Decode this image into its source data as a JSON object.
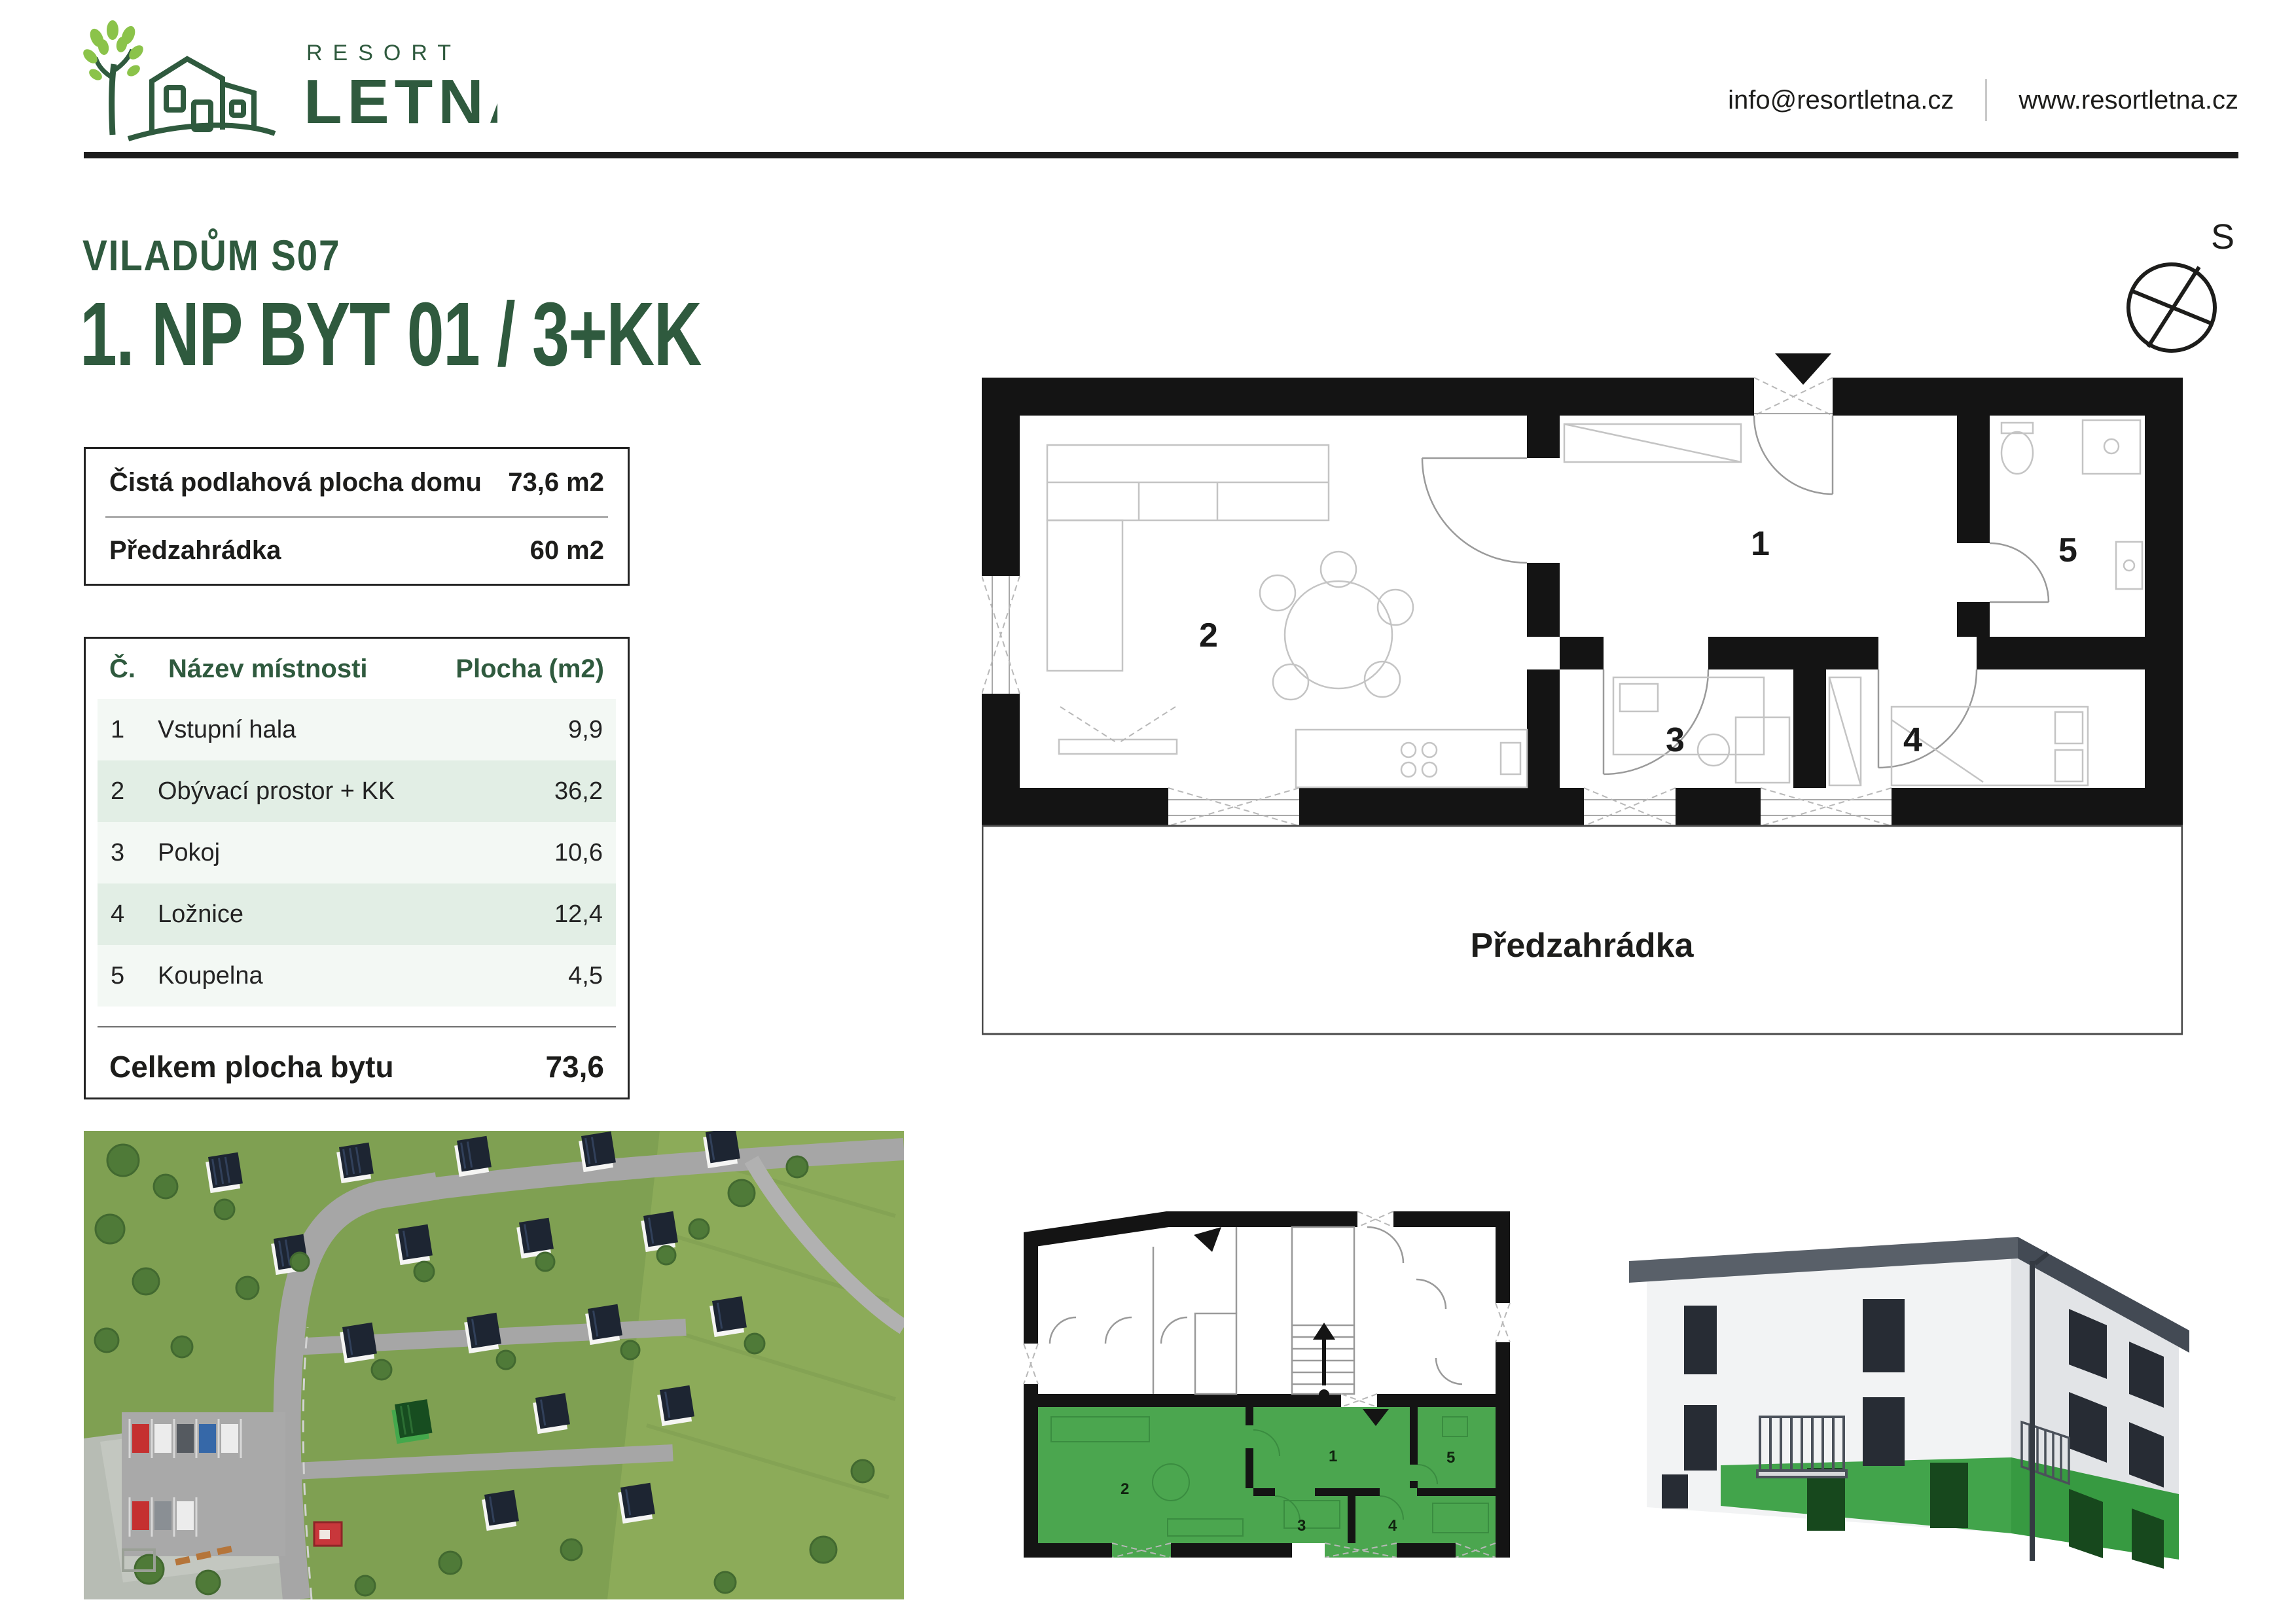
{
  "header": {
    "brand_top": "RESORT",
    "brand_bottom": "LETNÁ",
    "email": "info@resortletna.cz",
    "website": "www.resortletna.cz"
  },
  "title": {
    "project": "VILADŮM S07",
    "unit": "1. NP BYT 01 / 3+KK"
  },
  "summary": {
    "rows": [
      {
        "label": "Čistá podlahová plocha domu",
        "value": "73,6 m2"
      },
      {
        "label": "Předzahrádka",
        "value": "60 m2"
      }
    ]
  },
  "room_table": {
    "headers": {
      "number": "Č.",
      "name": "Název místnosti",
      "area": "Plocha (m2)"
    },
    "rows": [
      {
        "number": "1",
        "name": "Vstupní hala",
        "area": "9,9"
      },
      {
        "number": "2",
        "name": "Obývací prostor + KK",
        "area": "36,2"
      },
      {
        "number": "3",
        "name": "Pokoj",
        "area": "10,6"
      },
      {
        "number": "4",
        "name": "Ložnice",
        "area": "12,4"
      },
      {
        "number": "5",
        "name": "Koupelna",
        "area": "4,5"
      }
    ],
    "total": {
      "label": "Celkem plocha bytu",
      "value": "73,6"
    }
  },
  "floor_plan": {
    "room_labels": [
      "1",
      "2",
      "3",
      "4",
      "5"
    ],
    "garden_label": "Předzahrádka"
  },
  "compass": {
    "label": "S"
  },
  "mini_plan": {
    "room_labels": [
      "1",
      "2",
      "3",
      "4",
      "5"
    ]
  },
  "colors": {
    "accent_green": "#2f5a3e",
    "leaf_green": "#8bc34a",
    "highlight_green": "#4ba64f",
    "wall_black": "#141414",
    "row_light": "#f3f8f4",
    "row_alt": "#e2eee5"
  }
}
